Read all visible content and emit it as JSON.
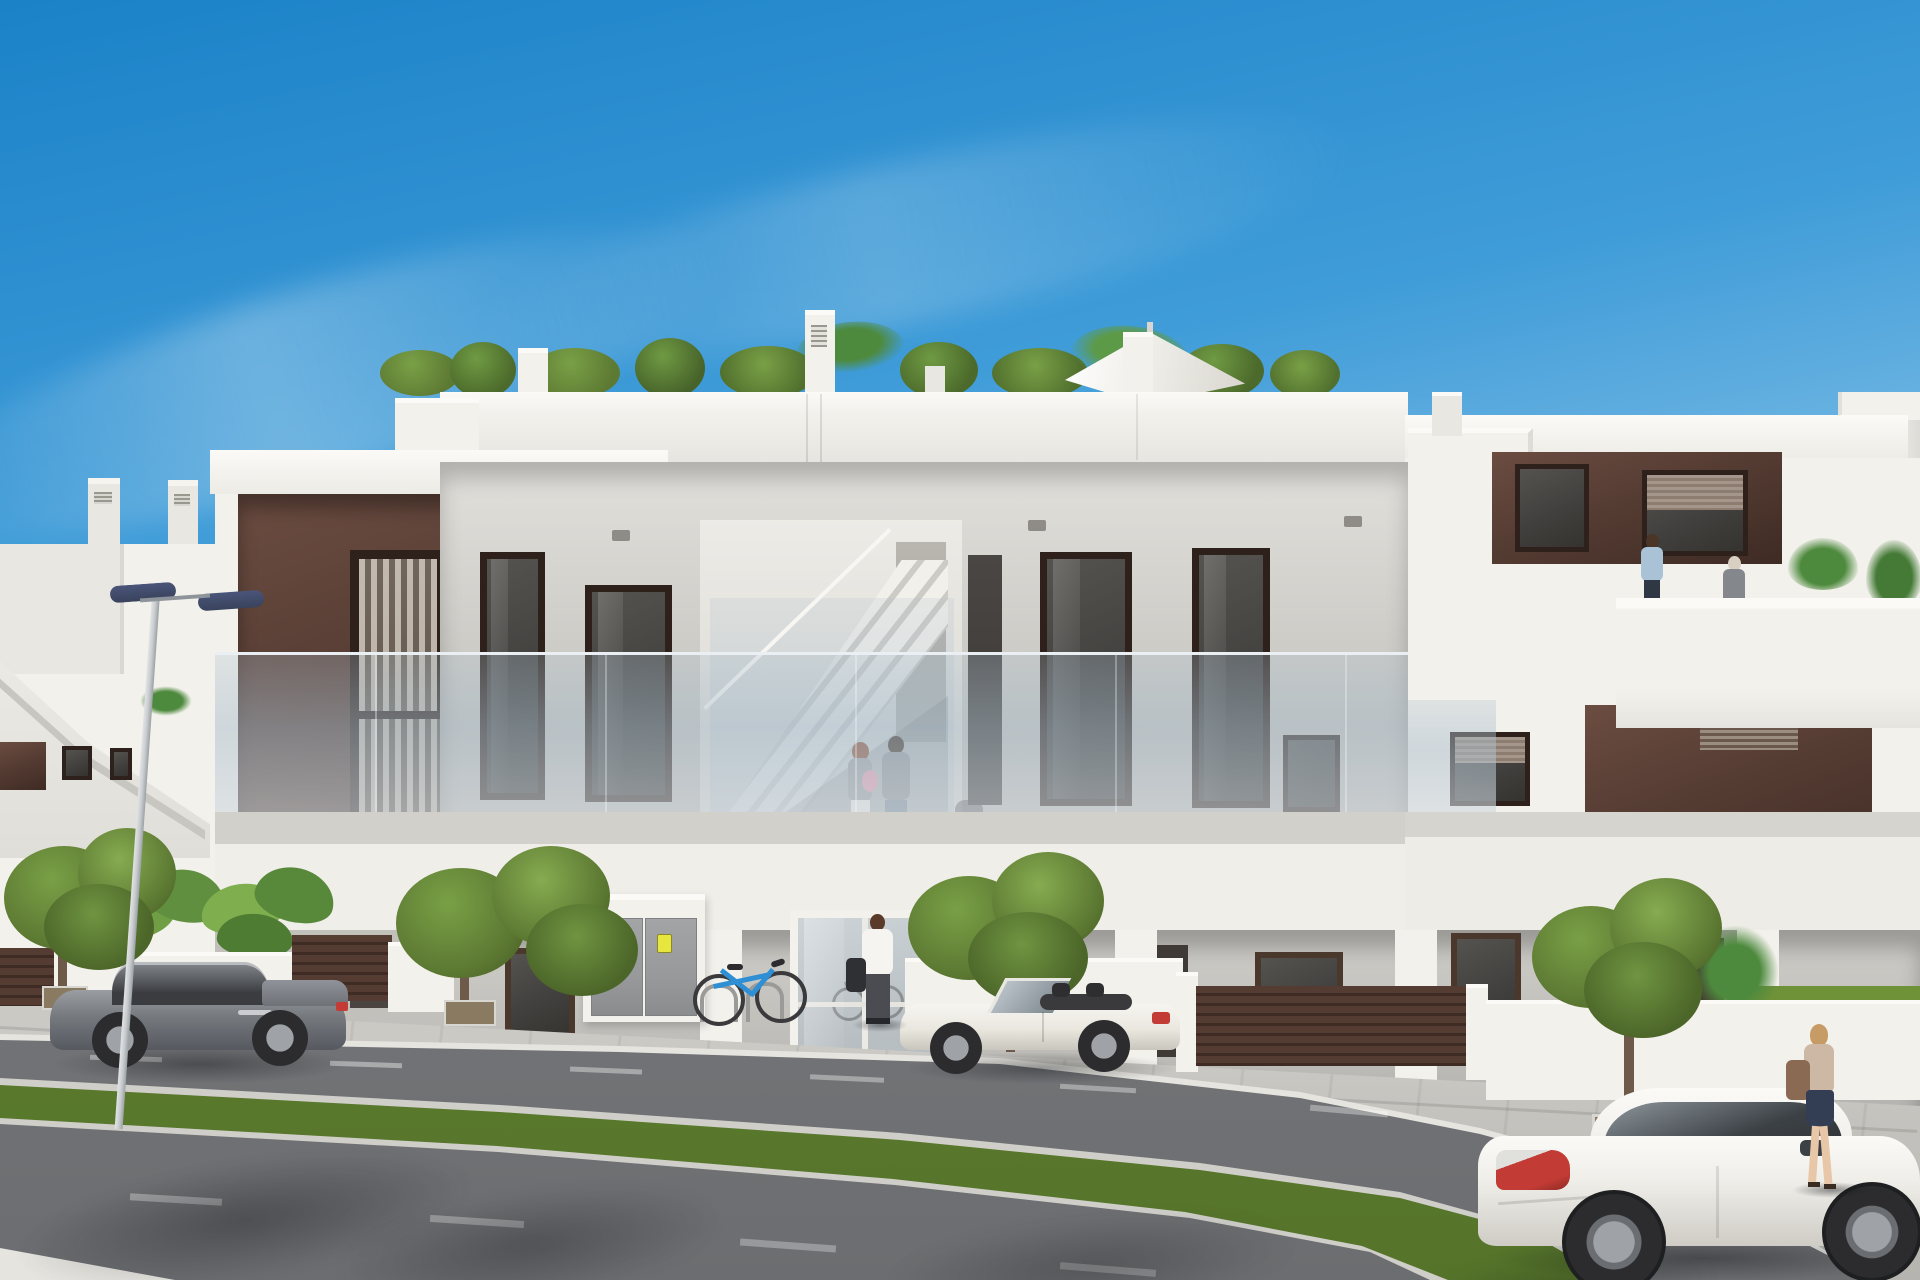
{
  "meta": {
    "title": "Architectural 3D render — modern white apartment building street view",
    "type": "photorealistic-render",
    "visible_text": []
  },
  "palette": {
    "sky_top": "#1b82c8",
    "sky_mid": "#3f9cd8",
    "sky_low": "#8ec6ea",
    "sky_horizon": "#cfe8f5",
    "facade_lit": "#f3f1ec",
    "facade_light2": "#e9e7e2",
    "facade_shade": "#d9d7d2",
    "facade_deep": "#c6c4c0",
    "recess": "#cfcdc8",
    "recess_dark": "#b9b7b3",
    "soffit": "#a8a6a2",
    "brown": "#553c33",
    "brown_dark": "#3e2b24",
    "brown_mid": "#6b4c41",
    "brown_light": "#8a6a5a",
    "frame": "#2e211b",
    "glass_dark": "#41403e",
    "glass_mid": "#55534f",
    "rail_glass": "#adbfcc",
    "blinds": "#b7aea1",
    "road": "#808285",
    "road_dark": "#6b6d70",
    "sidewalk": "#cac9c4",
    "sidewalk_dark": "#b5b4af",
    "curb": "#e5e4df",
    "grass": "#6f9138",
    "grass_dark": "#55742a",
    "tree": "#5d7a33",
    "tree_light": "#79a046",
    "tree_dark": "#435a22",
    "trunk": "#6e5a49",
    "palm": "#4e8a3e",
    "lamp_head": "#39435c",
    "pole": "#c9ccce",
    "cabinet": "#97999b",
    "cabinet_dark": "#7e8082",
    "sticker_yellow": "#e6e63e",
    "bike_blue": "#2e8fd4",
    "car_gray": "#75787d",
    "car_gray_dark": "#565960",
    "car_white": "#efeee9",
    "car_cream": "#eae7df",
    "tail_red": "#c23b34",
    "wheel": "#2c2c2e",
    "rim": "#9fa2a6",
    "skin": "#e8c6a8",
    "hair_brown": "#5a3a28",
    "hair_auburn": "#8a4a32",
    "hair_blond": "#c79b66",
    "shirt_white": "#f5f4f0",
    "shirt_blue": "#a9c2d6",
    "pants_dark": "#4a4c52",
    "jeans": "#7c8a99",
    "top_gray": "#9a9ea2",
    "skirt_navy": "#333d54",
    "bag_brown": "#8a6a52",
    "baby_pink": "#e59ab0"
  },
  "scene": {
    "setting": "sunny day, clear blue sky with thin cirrus clouds",
    "building": {
      "style": "modern three-level apartment block, white render with dark brown accent panels",
      "levels": [
        "ground floor porches and glazed entrance lobby",
        "first floor terraces with frameless glass balustrades",
        "roof terraces with planters, conifers, palms and a white parasol"
      ],
      "features": [
        "external staircase in central recess",
        "roller-shutter windows",
        "utility cabinet with two yellow warning stickers",
        "mailbox panel",
        "bicycle rack with blue bicycle",
        "brown slatted garden fences and gates"
      ]
    },
    "vehicles": [
      {
        "name": "gray coupe parked at left",
        "color_key": "car_gray"
      },
      {
        "name": "white convertible roadster parked at centre",
        "color_key": "car_cream"
      },
      {
        "name": "white coupe driving at bottom right",
        "color_key": "car_white"
      }
    ],
    "people": [
      {
        "name": "couple with baby on first-floor balcony"
      },
      {
        "name": "silhouette behind balcony glazing"
      },
      {
        "name": "man in white shirt at entrance"
      },
      {
        "name": "man in blue shirt on right roof terrace"
      },
      {
        "name": "woman on right roof terrace"
      },
      {
        "name": "woman with handbag walking on right sidewalk"
      }
    ],
    "street": [
      "tiled sidewalk",
      "asphalt carriageway with dashed lane markings",
      "diagonal grass median strip with kerbs",
      "double-headed street lamp",
      "four street trees and banana plants"
    ]
  }
}
